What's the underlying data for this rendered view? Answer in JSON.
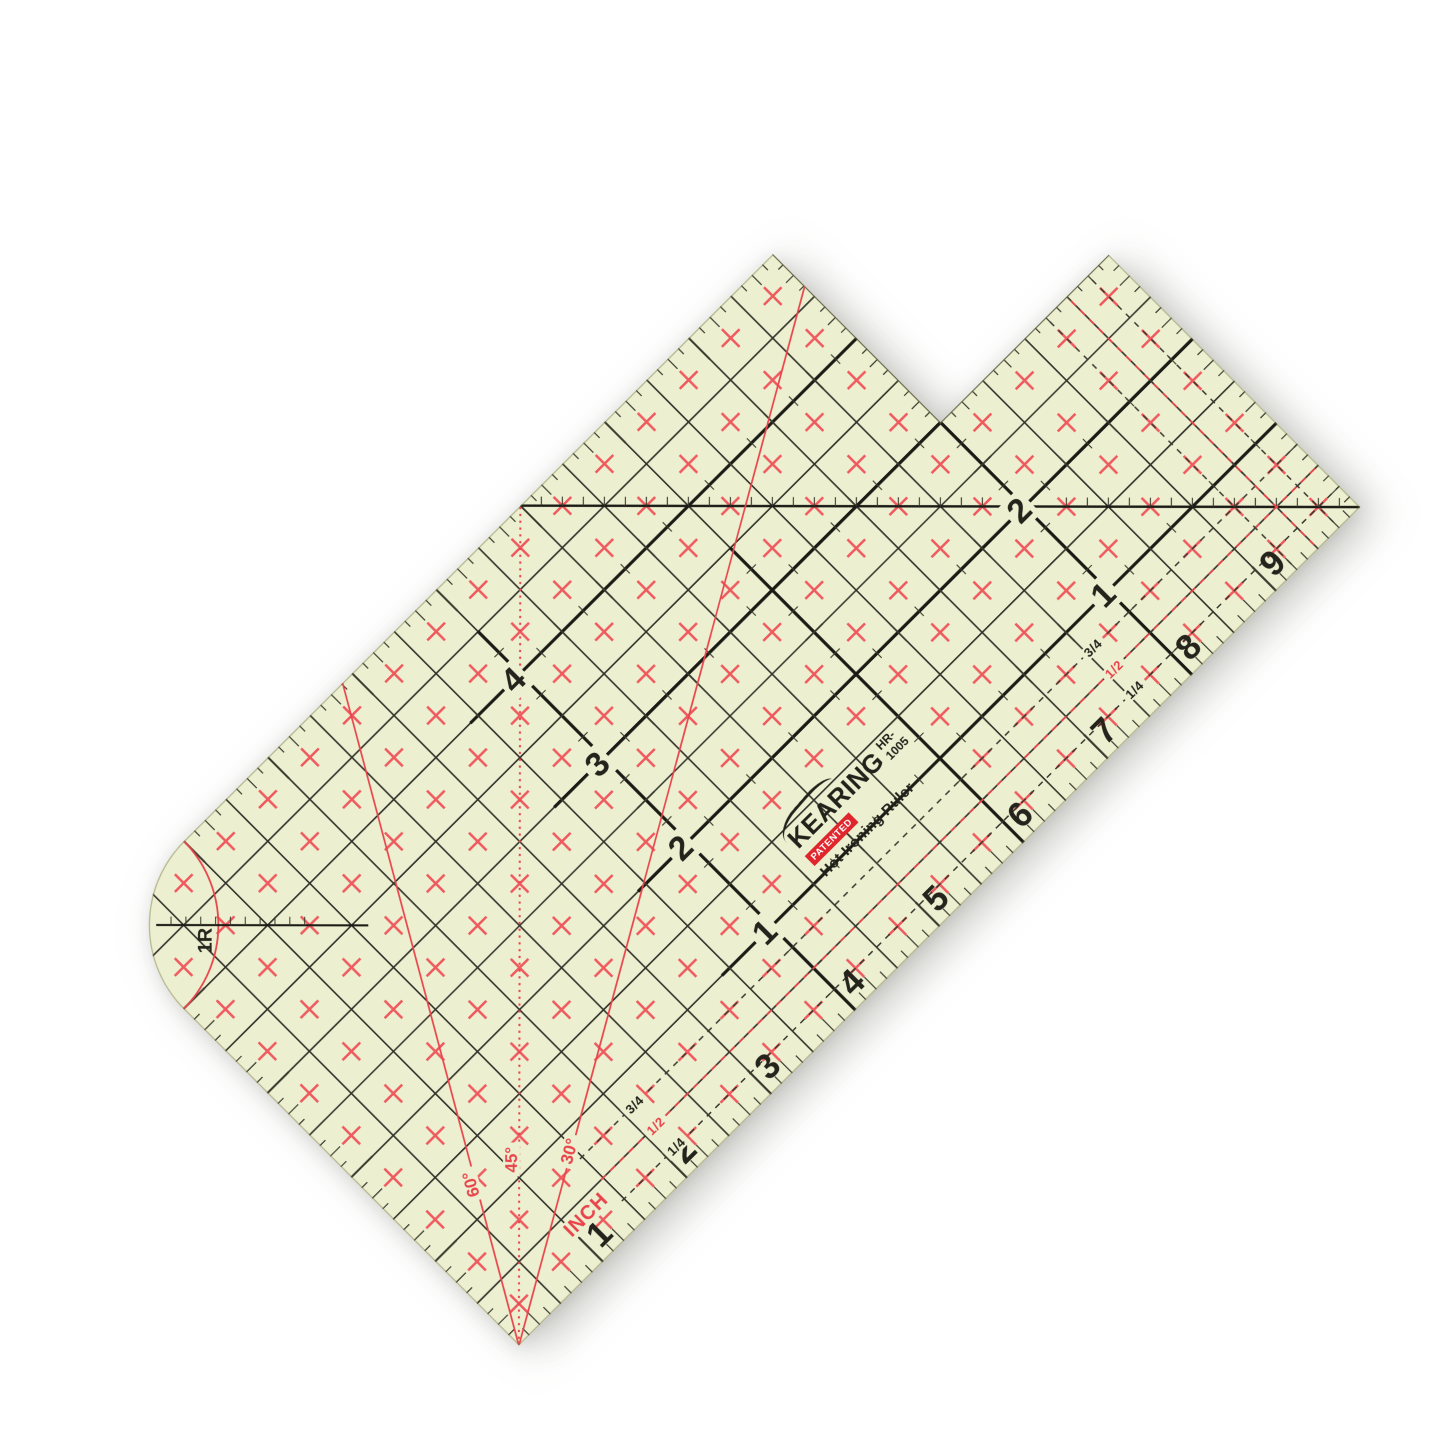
{
  "product": {
    "brand": "KEARING",
    "patented": "PATENTED",
    "model": "HR-1005",
    "name": "Hot Ironing Ruler"
  },
  "scales": {
    "bottom_numbers": [
      "1",
      "2",
      "3",
      "4",
      "5",
      "6",
      "7",
      "8",
      "9"
    ],
    "inner_left_numbers": [
      "4",
      "3",
      "2",
      "1"
    ],
    "inner_right_numbers": [
      "2",
      "1"
    ],
    "fractions": [
      "3/4",
      "1/2",
      "1/4"
    ],
    "angle_labels": [
      "60°",
      "45°",
      "30°"
    ],
    "unit_label": "INCH",
    "corner_radius_label": "1R"
  },
  "colors": {
    "page_background": "#ffffff",
    "ruler_body": "#edefd1",
    "grid_line": "#32322a",
    "bold_line": "#1b1b15",
    "tick": "#3a3a2e",
    "red": "#e8444a",
    "mark_red": "#ef5a5e",
    "text": "#24241c",
    "patent_box": "#e0262c",
    "edge_stroke": "rgba(125,130,75,0.5)"
  },
  "geometry": {
    "canvas_px": 1445,
    "inch_px": 118.8,
    "width_in": 10,
    "height_in": 5,
    "notch_in": 2,
    "corner_radius_in": 1,
    "rotation_deg": -44.9,
    "center_x": 730,
    "center_y": 716
  }
}
